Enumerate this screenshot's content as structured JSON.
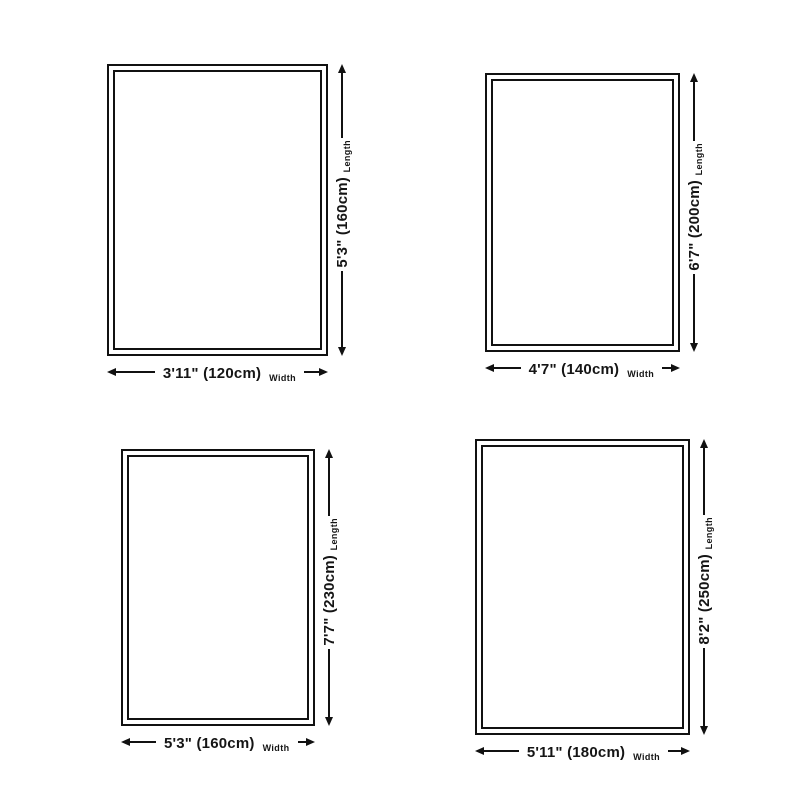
{
  "axis_labels": {
    "width": "Width",
    "length": "Length"
  },
  "rugs": [
    {
      "position": "top-left",
      "width_label": "3'11\" (120cm)",
      "length_label": "5'3\" (160cm)",
      "width_imperial": "3'11\"",
      "width_cm": 120,
      "length_imperial": "5'3\"",
      "length_cm": 160
    },
    {
      "position": "top-right",
      "width_label": "4'7\" (140cm)",
      "length_label": "6'7\" (200cm)",
      "width_imperial": "4'7\"",
      "width_cm": 140,
      "length_imperial": "6'7\"",
      "length_cm": 200
    },
    {
      "position": "bottom-left",
      "width_label": "5'3\" (160cm)",
      "length_label": "7'7\" (230cm)",
      "width_imperial": "5'3\"",
      "width_cm": 160,
      "length_imperial": "7'7\"",
      "length_cm": 230
    },
    {
      "position": "bottom-right",
      "width_label": "5'11\" (180cm)",
      "length_label": "8'2\" (250cm)",
      "width_imperial": "5'11\"",
      "width_cm": 180,
      "length_imperial": "8'2\"",
      "length_cm": 250
    }
  ],
  "colors": {
    "line": "#111111",
    "text": "#151515",
    "background": "#ffffff"
  }
}
